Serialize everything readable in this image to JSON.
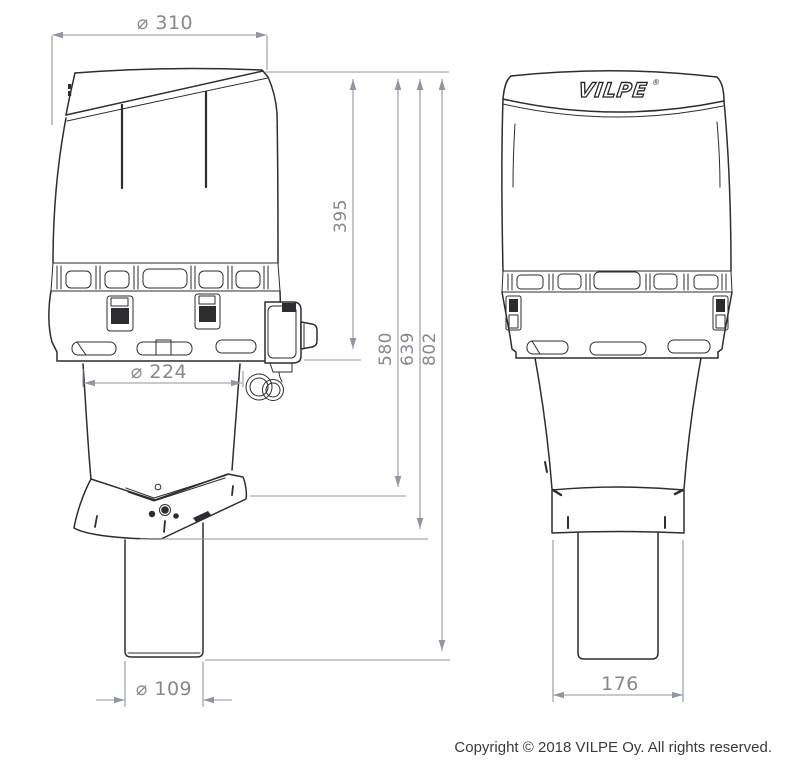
{
  "brand": {
    "logo_text": "VILPE",
    "registered_mark": "®"
  },
  "dimensions": {
    "cap_diameter": "⌀ 310",
    "upper_height": "395",
    "height_to_seal_top": "580",
    "height_to_seal_bottom": "639",
    "total_height": "802",
    "housing_diameter": "⌀ 224",
    "pipe_diameter": "⌀ 109",
    "base_width": "176"
  },
  "footer": {
    "copyright": "Copyright © 2018 VILPE Oy. All rights reserved."
  },
  "colors": {
    "outline": "#2d2d31",
    "dimension": "#9196a0",
    "dimension_text": "#87878f",
    "copyright_text": "#3a3a3a",
    "background": "#ffffff"
  }
}
